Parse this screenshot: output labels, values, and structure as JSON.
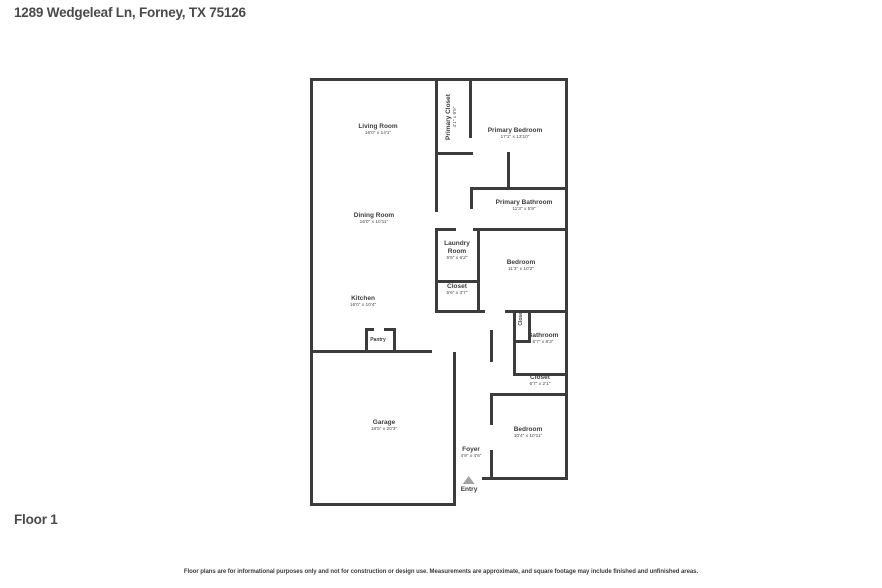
{
  "header": {
    "title": "1289 Wedgeleaf Ln, Forney, TX 75126"
  },
  "floor_label": "Floor 1",
  "disclaimer": "Floor plans are for informational purposes only and not for construction or design use. Measurements are approximate, and square footage may include finished and unfinished areas.",
  "entry_label": "Entry",
  "rooms": [
    {
      "name": "Living Room",
      "dims": "16'0\" x 14'1\""
    },
    {
      "name": "Primary Closet",
      "dims": "4'1\" x 9'5\""
    },
    {
      "name": "Primary Bedroom",
      "dims": "17'1\" x 13'10\""
    },
    {
      "name": "Primary Bathroom",
      "dims": "11'3\" x 5'9\""
    },
    {
      "name": "Dining Room",
      "dims": "16'0\" x 10'11\""
    },
    {
      "name": "Laundry Room",
      "dims": "5'6\" x 6'2\""
    },
    {
      "name": "Bedroom",
      "dims": "11'3\" x 10'2\""
    },
    {
      "name": "Closet",
      "dims": "5'6\" x 3'7\""
    },
    {
      "name": "Kitchen",
      "dims": "16'0\" x 10'4\""
    },
    {
      "name": "Closet",
      "dims": ""
    },
    {
      "name": "Bathroom",
      "dims": "6'7\" x 8'3\""
    },
    {
      "name": "Closet",
      "dims": "6'7\" x 2'1\""
    },
    {
      "name": "Pantry",
      "dims": ""
    },
    {
      "name": "Bedroom",
      "dims": "10'4\" x 10'11\""
    },
    {
      "name": "Garage",
      "dims": "18'5\" x 20'3\""
    },
    {
      "name": "Foyer",
      "dims": "4'9\" x 4'6\""
    }
  ]
}
